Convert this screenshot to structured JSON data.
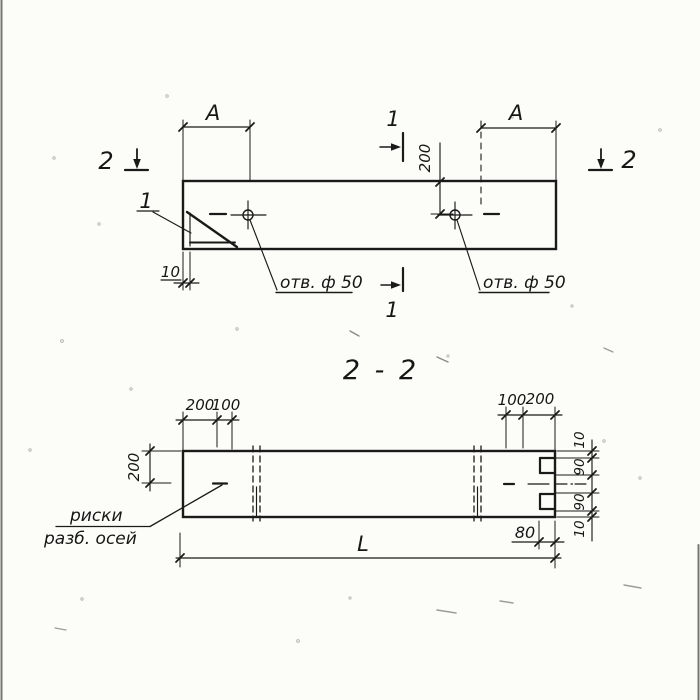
{
  "meta": {
    "drawing_kind": "scanned construction drawing, plan view and section",
    "ink_color": "#1a1a1a",
    "paper_color": "#fcfcf9"
  },
  "plan": {
    "dim_a_left": "А",
    "dim_a_right": "А",
    "dim_200_to_hole": "200",
    "dim_10_edge": "10",
    "hole_label_left": "отв. ф 50",
    "hole_label_right": "отв. ф 50",
    "detail_mark": "1",
    "section_mark_1_top": "1",
    "section_mark_1_bottom": "1",
    "section_mark_2_left": "2",
    "section_mark_2_right": "2"
  },
  "section": {
    "title": "2 - 2",
    "dim_top_left_200": "200",
    "dim_top_left_100": "100",
    "dim_top_right_100": "100",
    "dim_top_right_200": "200",
    "dim_height_200": "200",
    "dim_right_top_10": "10",
    "dim_right_top_90": "90",
    "dim_right_bottom_90": "90",
    "dim_right_bottom_10": "10",
    "dim_notch_80": "80",
    "dim_length_L": "L",
    "riska_label_line1": "риски",
    "riska_label_line2": "разб. осей"
  }
}
